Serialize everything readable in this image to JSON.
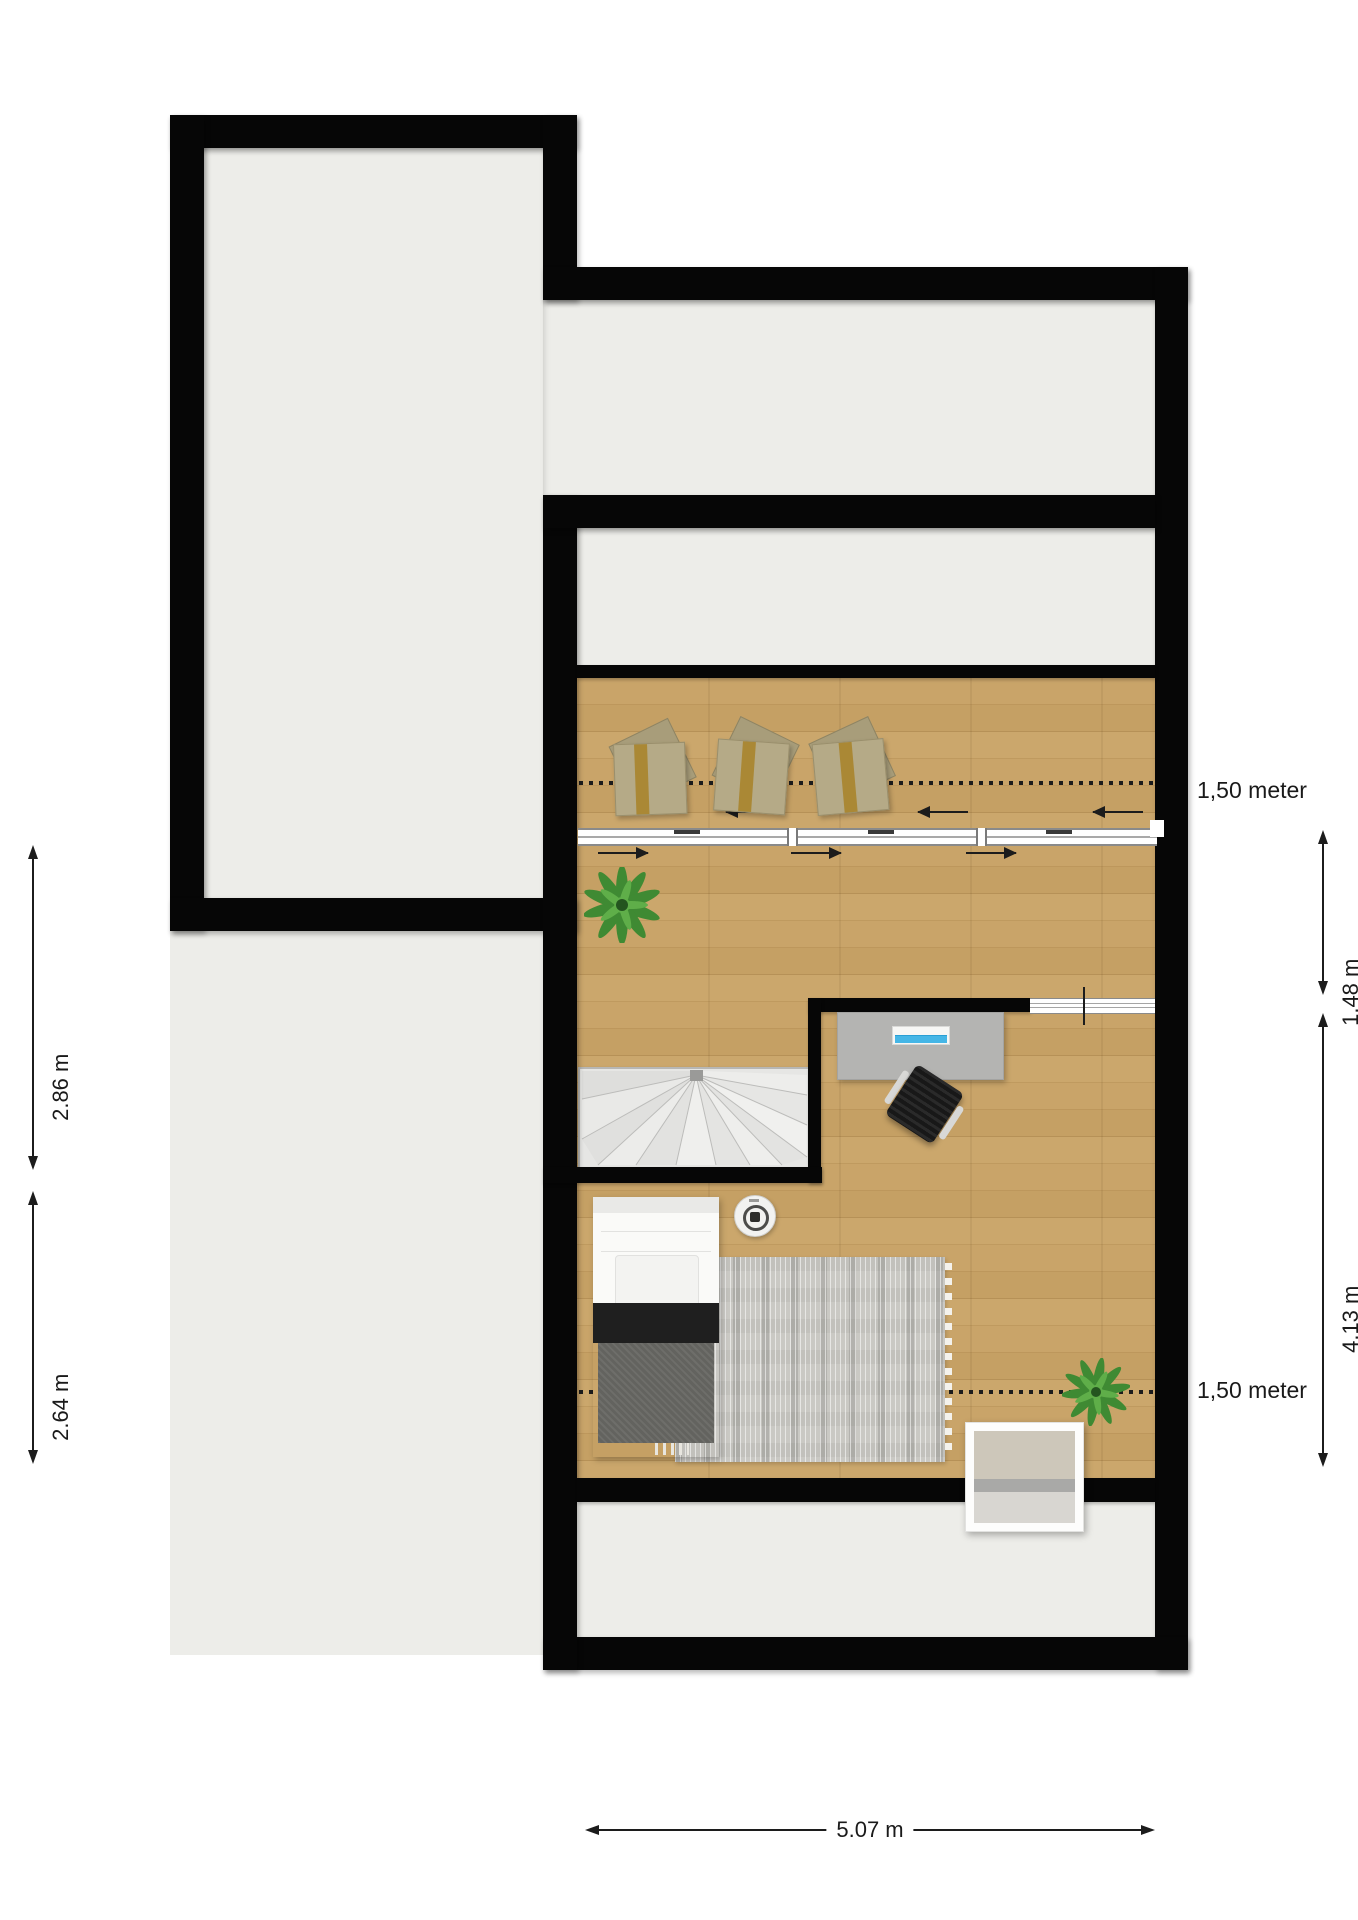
{
  "document": {
    "type": "attic-floor-plan",
    "background_color": "#ffffff"
  },
  "labels": {
    "headroom_upper": "1,50 meter",
    "headroom_lower": "1,50 meter"
  },
  "dimensions": {
    "right_upper": "1.48 m",
    "right_lower": "4.13 m",
    "left_upper": "2.86 m",
    "left_lower": "2.64 m",
    "bottom": "5.07 m"
  },
  "colors": {
    "wall": "#060606",
    "room_interior": "#edede9",
    "wood_floor": "#c49f63",
    "rug": "#cac9c4",
    "laptop_screen_accent": "#45b6e6",
    "plant_green": "#3f8a33",
    "gift_box": "#b5aa87",
    "gift_ribbon": "#a8842c",
    "bed_blanket_dark": "#1f1f1f",
    "bed_blanket_gray": "#63635f",
    "stairs_fill": "#e6e6e4",
    "desk": "#b4b4b2"
  },
  "objects": [
    "upper-left-room",
    "open-attic-area",
    "top-strip-room",
    "middle-strip-room",
    "main-wood-room",
    "bottom-strip-room",
    "sliding-roof-window-row",
    "gift-box",
    "gift-box",
    "gift-box",
    "plant",
    "plant",
    "spiral-stairs",
    "desk",
    "laptop",
    "office-chair",
    "bed",
    "rug",
    "smoke-detector",
    "cabinet",
    "headroom-dotted-line",
    "headroom-dotted-line"
  ]
}
